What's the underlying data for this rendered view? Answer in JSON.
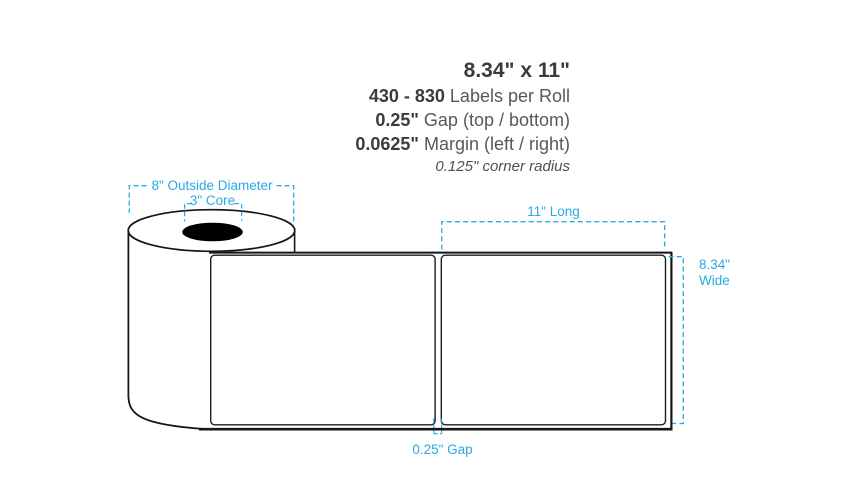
{
  "specs": {
    "size": "8.34\" x 11\"",
    "lines": [
      {
        "value": "430 - 830",
        "label": "Labels per Roll"
      },
      {
        "value": "0.25\"",
        "label": "Gap (top / bottom)"
      },
      {
        "value": "0.0625\"",
        "label": "Margin (left / right)"
      }
    ],
    "note": "0.125\" corner radius"
  },
  "diagram": {
    "annotations": {
      "outside_diameter": "8\" Outside Diameter",
      "core": "3\" Core",
      "length": "11\" Long",
      "width_line1": "8.34\"",
      "width_line2": "Wide",
      "gap": "0.25\" Gap"
    },
    "colors": {
      "annotation_blue": "#29ABE2",
      "line_black": "#161616"
    }
  }
}
